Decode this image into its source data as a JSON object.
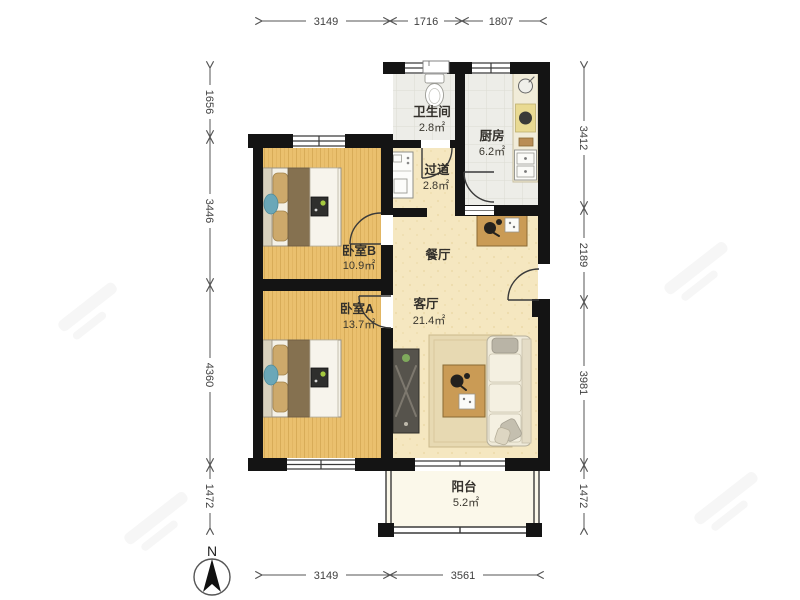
{
  "page": {
    "background": "#ffffff"
  },
  "north": {
    "label": "N"
  },
  "rooms": {
    "bathroom": {
      "name": "卫生间",
      "area": "2.8㎡"
    },
    "kitchen": {
      "name": "厨房",
      "area": "6.2㎡"
    },
    "hallway": {
      "name": "过道",
      "area": "2.8㎡"
    },
    "bedroom_b": {
      "name": "卧室B",
      "area": "10.9㎡"
    },
    "dining": {
      "name": "餐厅",
      "area": ""
    },
    "living": {
      "name": "客厅",
      "area": "21.4㎡"
    },
    "bedroom_a": {
      "name": "卧室A",
      "area": "13.7㎡"
    },
    "balcony": {
      "name": "阳台",
      "area": "5.2㎡"
    }
  },
  "dimensions": {
    "top": [
      "3149",
      "1716",
      "1807"
    ],
    "left": [
      "1656",
      "3446",
      "4360",
      "1472"
    ],
    "right": [
      "3412",
      "2189",
      "3981",
      "1472"
    ],
    "bottom": [
      "3149",
      "3561"
    ]
  },
  "colors": {
    "wall": "#141414",
    "bedroom_floor": "#EAC06E",
    "living_floor": "#F5E7C0",
    "wet_floor": "#EDEDE8",
    "balcony_floor": "#FBF8EA",
    "dim_line": "#555555"
  }
}
